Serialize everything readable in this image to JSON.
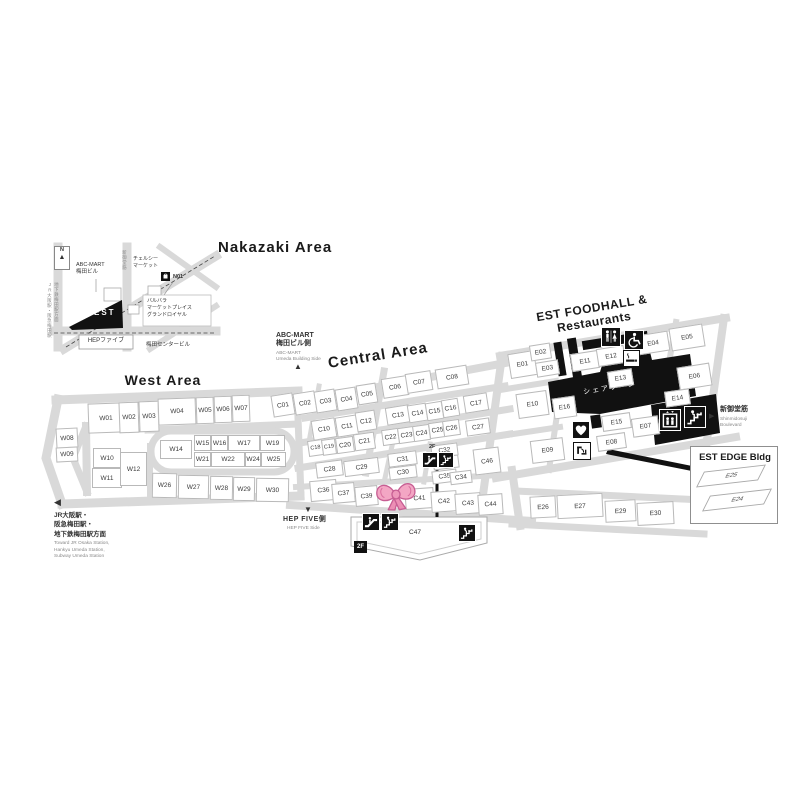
{
  "inset": {
    "compass": "N",
    "station_side_vertical": [
      "JR大阪駅・阪急梅田駅",
      "地下鉄梅田駅方面"
    ],
    "road_vertical": "新御堂筋",
    "labels": {
      "abc_mart": "ABC-MART\n梅田ビル",
      "chelsea": "チェルシー\nマーケット",
      "n01": "N01",
      "barbara": "バルバラ\nマーケットプレイス\nグランドロイヤル",
      "est": "EST",
      "hep_five": "HEPファイブ",
      "umeda_center": "梅田センタービル"
    }
  },
  "areas": {
    "nakazaki": {
      "title": "Nakazaki Area"
    },
    "west": {
      "title": "West Area",
      "units": [
        "W01",
        "W02",
        "W03",
        "W04",
        "W05",
        "W06",
        "W07",
        "W08",
        "W09",
        "W10",
        "W11",
        "W12",
        "W14",
        "W15",
        "W16",
        "W17",
        "W19",
        "W21",
        "W22",
        "W24",
        "W25",
        "W26",
        "W27",
        "W28",
        "W29",
        "W30"
      ]
    },
    "central": {
      "title": "Central Area",
      "units": [
        "C01",
        "C02",
        "C03",
        "C04",
        "C05",
        "C06",
        "C07",
        "C08",
        "C10",
        "C11",
        "C12",
        "C13",
        "C14",
        "C15",
        "C16",
        "C17",
        "C18",
        "C19",
        "C20",
        "C21",
        "C22",
        "C23",
        "C24",
        "C25",
        "C26",
        "C27",
        "C28",
        "C29",
        "C31",
        "C30",
        "C32",
        "C33",
        "C35",
        "C34",
        "C46",
        "C36",
        "C37",
        "C39",
        "C41",
        "C42",
        "C43",
        "C44",
        "C47"
      ]
    },
    "east": {
      "title": "EST FOODHALL & Restaurants",
      "share_zone": "シェアゾーン",
      "units": [
        "E01",
        "E02",
        "E03",
        "E11",
        "E12",
        "E04",
        "E05",
        "E13",
        "E06",
        "E10",
        "E16",
        "E15",
        "E07",
        "E08",
        "E09",
        "E14",
        "E26",
        "E27",
        "E29",
        "E30"
      ]
    },
    "edge": {
      "title": "EST EDGE Bldg",
      "units": [
        "E25",
        "E24"
      ]
    }
  },
  "directions": {
    "abc_mart_jp": "ABC-MART\n梅田ビル側",
    "abc_mart_en": "ABC-MART\nUmeda Building Side",
    "hep_jp": "HEP FIVE側",
    "hep_en": "HEP FIVE Side",
    "stations_jp": "JR大阪駅・\n阪急梅田駅・\n地下鉄梅田駅方面",
    "stations_en": "Toward JR Osaka Station,\nHankyu Umeda Station,\nSubway Umeda Station",
    "shinmido_jp": "新御堂筋",
    "shinmido_en": "Shinmidosuji\nBoulevard"
  },
  "markers": {
    "floor": "2F",
    "bow": "pink-ribbon-bow"
  },
  "arrows": {
    "up": "▲",
    "down": "▼",
    "left": "◀",
    "right": "▶"
  },
  "icons": {
    "restroom": "restroom-icon",
    "wheelchair": "wheelchair-icon",
    "smoking": "smoking-area-icon",
    "escalator": "escalator-icon",
    "stairs": "stairs-icon",
    "elevator": "elevator-icon",
    "aed": "heart-aed-icon",
    "fountain": "drinking-fountain-icon",
    "compass": "north-compass-icon",
    "bow": "pink-bow-marker"
  },
  "colors": {
    "road": "#d9d9d9",
    "black": "#111111",
    "bow_pink": "#f3a6c4",
    "bow_outline": "#c75e93"
  }
}
